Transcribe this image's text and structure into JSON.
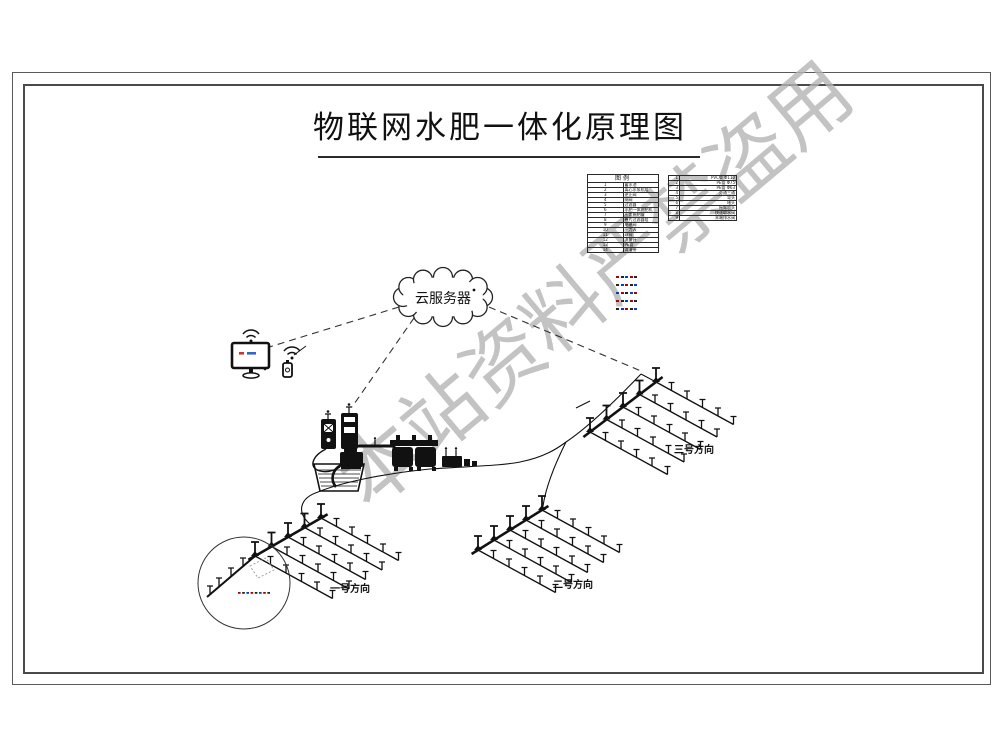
{
  "page": {
    "title": "物联网水肥一体化原理图"
  },
  "watermark": {
    "text": "本站资料严禁盗用",
    "color": "#b5b5b5"
  },
  "cloud": {
    "label": "云服务器"
  },
  "fields": {
    "f1": {
      "label": "一号方向"
    },
    "f2": {
      "label": "二号方向"
    },
    "f3": {
      "label": "三号方向"
    }
  },
  "legend_left": {
    "title": "图例",
    "rows": [
      {
        "num": "1",
        "label": "蓄水池"
      },
      {
        "num": "2",
        "label": "离心水泵机组"
      },
      {
        "num": "3",
        "label": "逆止阀"
      },
      {
        "num": "4",
        "label": "闸阀"
      },
      {
        "num": "5",
        "label": "过滤器"
      },
      {
        "num": "6",
        "label": "水肥一体施肥机"
      },
      {
        "num": "7",
        "label": "压差施肥罐"
      },
      {
        "num": "8",
        "label": "叠片过滤器组"
      },
      {
        "num": "9",
        "label": "电磁阀"
      },
      {
        "num": "10",
        "label": "压力表"
      },
      {
        "num": "11",
        "label": "球阀"
      },
      {
        "num": "12",
        "label": "流量计"
      },
      {
        "num": "13",
        "label": "PE管"
      },
      {
        "num": "14",
        "label": "滴灌带"
      }
    ]
  },
  "legend_right": {
    "rows": [
      {
        "num": "1",
        "label": "PVC管 Φ110"
      },
      {
        "num": "2",
        "label": "PE管 Φ75"
      },
      {
        "num": "3",
        "label": "PE管 Φ63"
      },
      {
        "num": "4",
        "label": "旁通三通"
      },
      {
        "num": "5",
        "label": "弯头"
      },
      {
        "num": "6",
        "label": "堵头"
      },
      {
        "num": "7",
        "label": "摇臂喷头"
      },
      {
        "num": "8",
        "label": "快速取水阀"
      },
      {
        "num": "9",
        "label": "末端排水阀"
      }
    ]
  },
  "line_legend": {
    "count": 5
  },
  "colors": {
    "ink": "#1a1a1a",
    "screen_red": "#cc3333",
    "screen_blue": "#3366cc",
    "sample_colors": [
      "#b00000",
      "#222222",
      "#0044bb"
    ]
  }
}
